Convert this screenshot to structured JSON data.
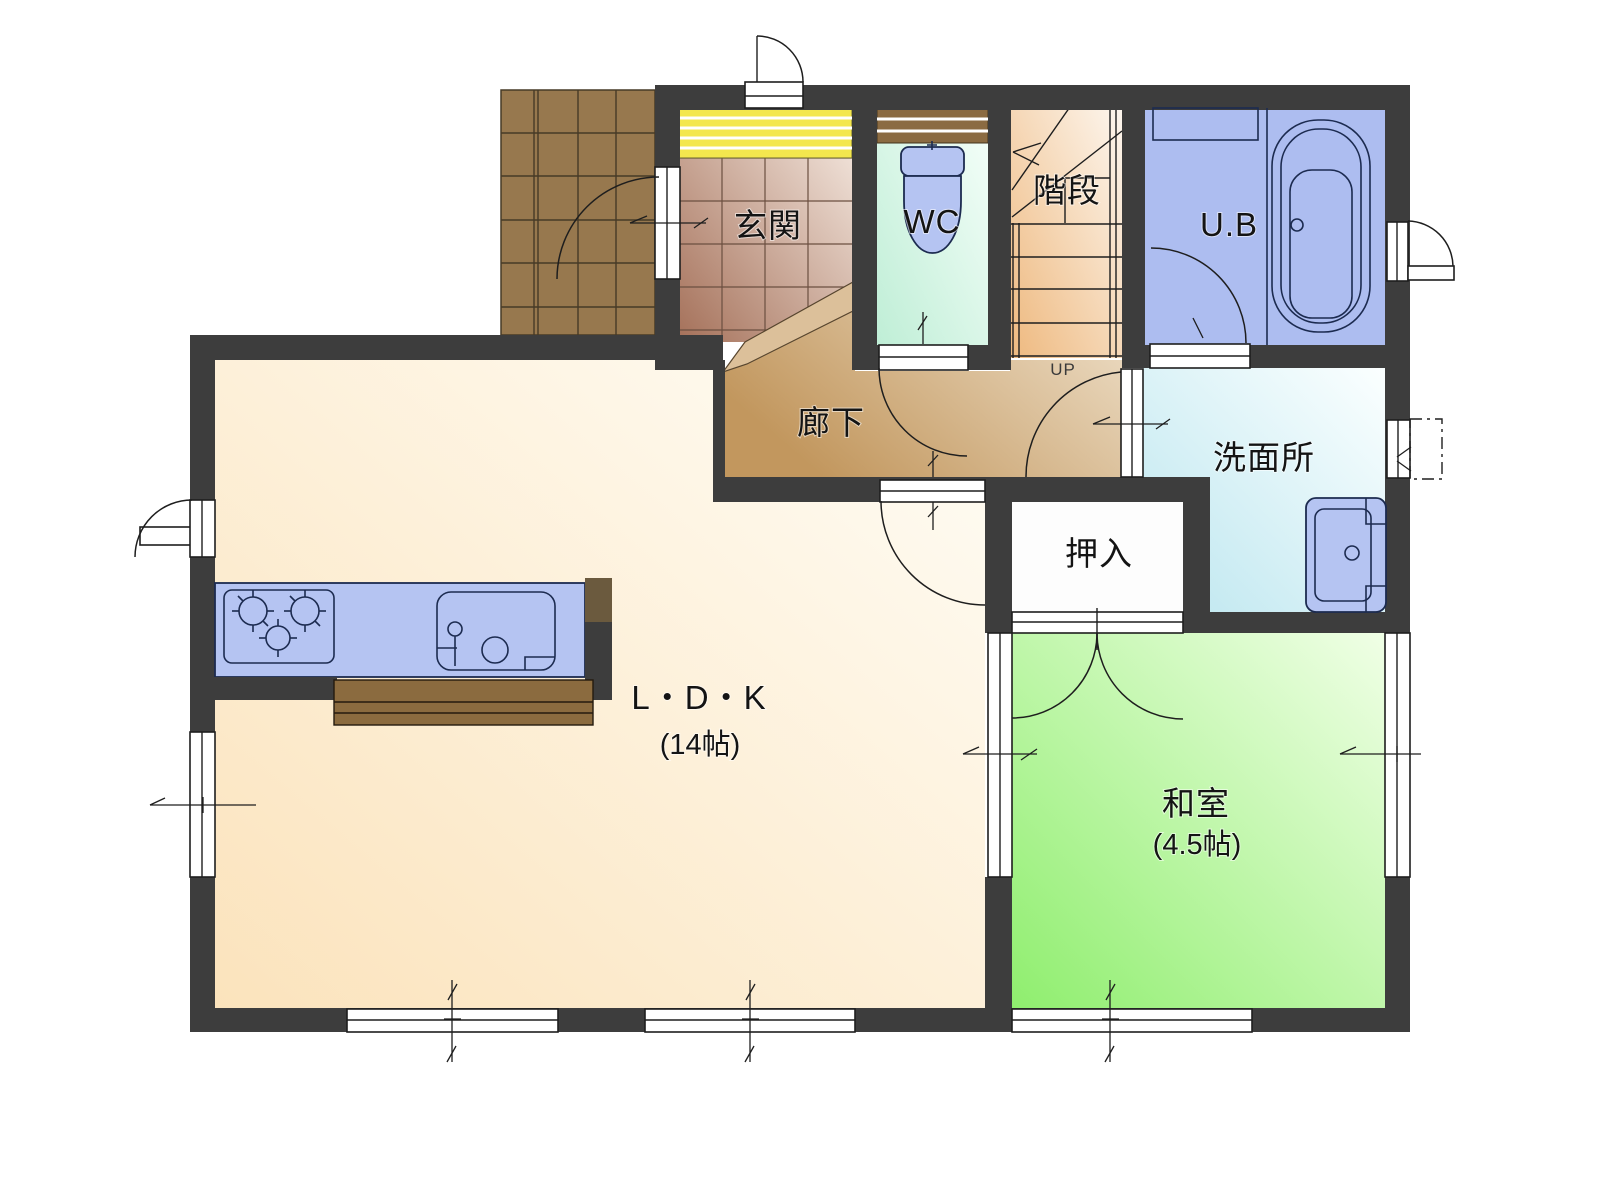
{
  "plan": {
    "type": "floor-plan",
    "floor": "1F",
    "labels": {
      "genkan": "玄関",
      "wc": "WC",
      "stairs": "階段",
      "bath": "U.B",
      "hallway": "廊下",
      "washroom": "洗面所",
      "closet": "押入",
      "ldk": "L・D・K",
      "ldk_size": "(14帖)",
      "washitsu": "和室",
      "washitsu_size": "(4.5帖)",
      "stairs_up": "UP"
    },
    "colors": {
      "wall": "#3d3d3d",
      "ldk_floor": "#fae3c0",
      "washitsu_floor": "#90ee70",
      "genkan_tile": "#aa7a5c",
      "porch_tile": "#97784e",
      "hallway_floor": "#c49a63",
      "wc_floor": "#c2eed8",
      "stairs_floor": "#eebd85",
      "bath_floor": "#adbdf0",
      "washroom_floor": "#bfe7ef",
      "fixture_blue": "#b5c4f2",
      "wood_counter": "#8b6b3f",
      "mat_yellow": "#f3e74e"
    }
  }
}
